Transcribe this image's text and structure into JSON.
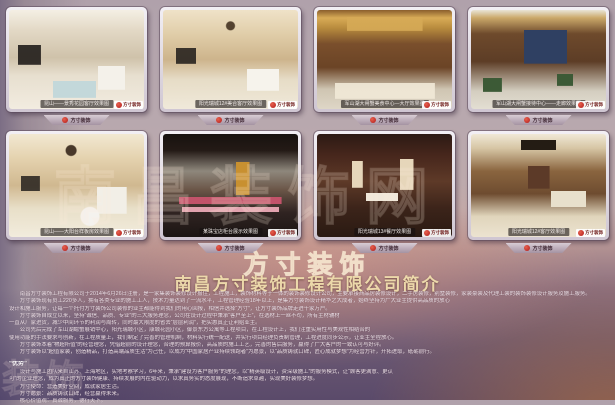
{
  "logo": {
    "name": "方寸装饰"
  },
  "header": {
    "company_title": "南昌方寸装饰工程有限公司简介"
  },
  "watermark": {
    "main": "南昌装饰网",
    "fragment": "装饰"
  },
  "photo_badge": {
    "label": "方寸装饰"
  },
  "banner": {
    "label": "方寸装饰"
  },
  "photos": [
    {
      "caption": "昆山——景秀花园客厅效果图"
    },
    {
      "caption": "阳光瑞城12#美合客厅效果图"
    },
    {
      "caption": "军山湖大闸蟹美食中心—大厅效果图"
    },
    {
      "caption": "军山湖大闸蟹接待中心——走廊效果图"
    },
    {
      "caption": "昆山——大阳台样板房效果图"
    },
    {
      "caption": "某珠宝店柜台展示效果图"
    },
    {
      "caption": "阳光瑞城13#餐厅效果图"
    },
    {
      "caption": "阳光瑞城12#客厅效果图"
    }
  ],
  "body": {
    "lines": [
      "南昌方寸装饰工程有限公司于2014年6月26日注册，是一家集装饰装修设计报住，工程施工，装饰材料等于一体的装饰装修设计公司，主要承接商品房装修设计，二手房装修，别墅装修，家装豪装及代理工装的装饰装修设计服务及施工服务。",
      "方寸装饰现有员工220多人，拥有各类专业的施工工人，技术力量达到了一流水平，工程管理经验18年以上，是集方寸装饰设计精华之大成者，始终坚持为广大业主提供高品质的放心",
      "设计和施工服务，让每一个托付方寸装饰公司装修的业主都能得到我们的用心回报，相信并选择“方寸”，让方寸装饰品牌走进千家万户。",
      "方寸装饰自成立以来，坚持“诚信、品质、专业”的三大服务理念，公司在设计过程中秉承“客户至上”，在选材上一丝不苟，所有主材辅材",
      "一直从厂家进货，减少中间环节的利润与周转，同时最大限度的省去“层层利润”，把实惠真正让利给业主。",
      "公司先后完成了军山湖螃蟹展销中心，阳光瑞城小区，康城花园小区，御景东方公寓等工程项目，在工程设计上，我们注重实用性与美观性相结合的",
      "使用功能的手法要求与创新，在工程质量上，我们制定了完善的管理机制，材料实行统一配送，并实行项目经理负责制管理，工程进度同步公示，让业主全程放心。",
      "方寸装饰本着“物超所值”的经营理念，凭借超前的设计理念，合理的预算报价，高品质的施工工艺，完善的售后服务，赢得了广大客户的一致认可与好评。",
      "方寸装饰以“超值家装，创造精品，打造高端品质生活”为己任，以成为“中国家居产业持续领跑者”为愿景，以“品质铸就口碑，匠心成就梦想”为经营方针，开拓进取，砥砺前行。"
    ],
    "advantage_header": "“优势”",
    "adv_lines": [
      "设计与施工团队来自江苏、上海地区，实地考察学习，6年来，秉承“建设为客户服务”的理念，以“精英级设计，资深级施工”的服务模式，让“顾客更满意、更认",
      "可”的企业理念，成为真正的方寸装饰健康、持续发展的内在驱动力，以求真务实的态度展现，不断追求卓越，实现美好装修梦想。"
    ],
    "mission": [
      "方寸使命：营造美好空间，成就家居生活。",
      "方寸愿景：品质铸就口碑，经营赢得未来。",
      "核心价值观：真诚服务，德行天下。"
    ]
  }
}
